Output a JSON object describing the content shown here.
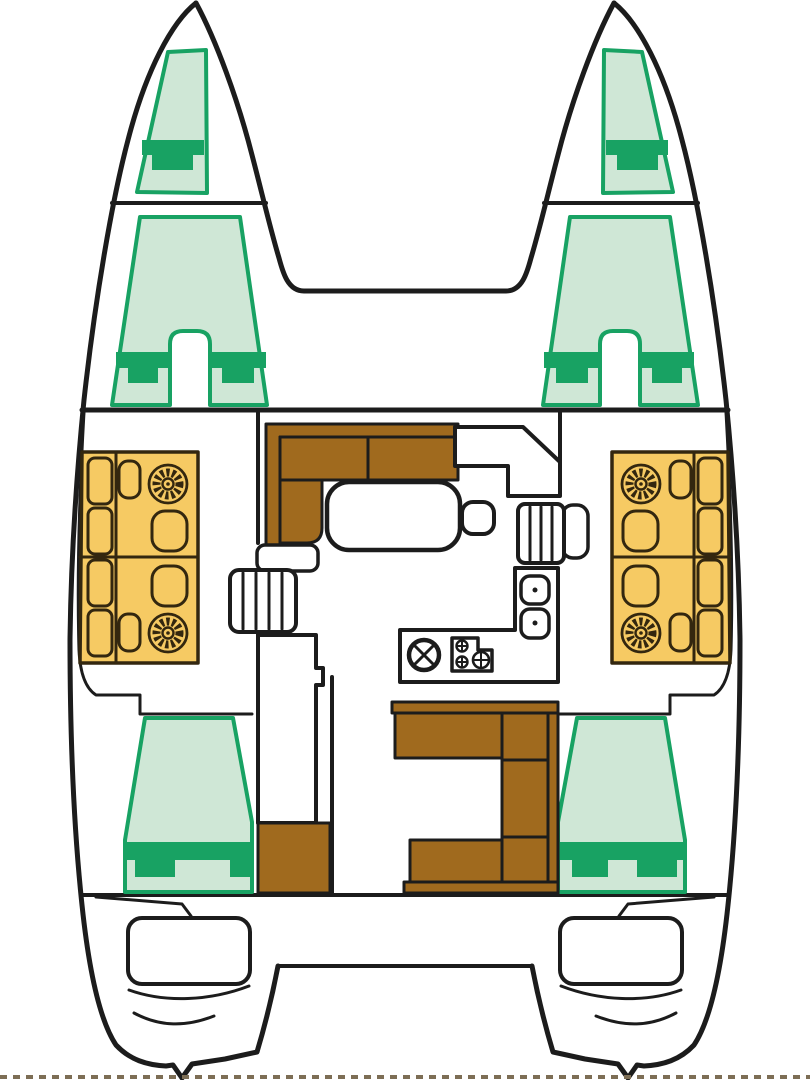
{
  "diagram": {
    "kind": "catamaran-yacht-floor-plan",
    "view": "top-down-deck-layout"
  },
  "colors": {
    "background": "#ffffff",
    "outline": "#1c1c1c",
    "berth_fill": "#cfe7d6",
    "berth_accent": "#18a263",
    "bathroom_fill": "#f6ca63",
    "bathroom_line": "#33270f",
    "furniture_brown": "#a06a1e",
    "torn_edge": "#7d6e55"
  },
  "regions": [
    {
      "id": "port-forepeak-berth",
      "type": "berth"
    },
    {
      "id": "starboard-forepeak-berth",
      "type": "berth"
    },
    {
      "id": "port-forward-cabin-bed",
      "type": "berth"
    },
    {
      "id": "starboard-forward-cabin-bed",
      "type": "berth"
    },
    {
      "id": "port-head-forward",
      "type": "bathroom"
    },
    {
      "id": "port-head-aft",
      "type": "bathroom"
    },
    {
      "id": "starboard-head-forward",
      "type": "bathroom"
    },
    {
      "id": "starboard-head-aft",
      "type": "bathroom"
    },
    {
      "id": "saloon-sofa",
      "type": "seating"
    },
    {
      "id": "saloon-table",
      "type": "table"
    },
    {
      "id": "galley",
      "type": "galley"
    },
    {
      "id": "companionway-stairs-port",
      "type": "stairs"
    },
    {
      "id": "companionway-stairs-starboard",
      "type": "stairs"
    },
    {
      "id": "port-aft-cabin-bed",
      "type": "berth"
    },
    {
      "id": "starboard-aft-cabin-bed",
      "type": "berth"
    },
    {
      "id": "cockpit-seating",
      "type": "seating"
    },
    {
      "id": "cockpit-bench-port",
      "type": "seating"
    },
    {
      "id": "transom-platform-port",
      "type": "platform"
    },
    {
      "id": "transom-platform-starboard",
      "type": "platform"
    }
  ]
}
